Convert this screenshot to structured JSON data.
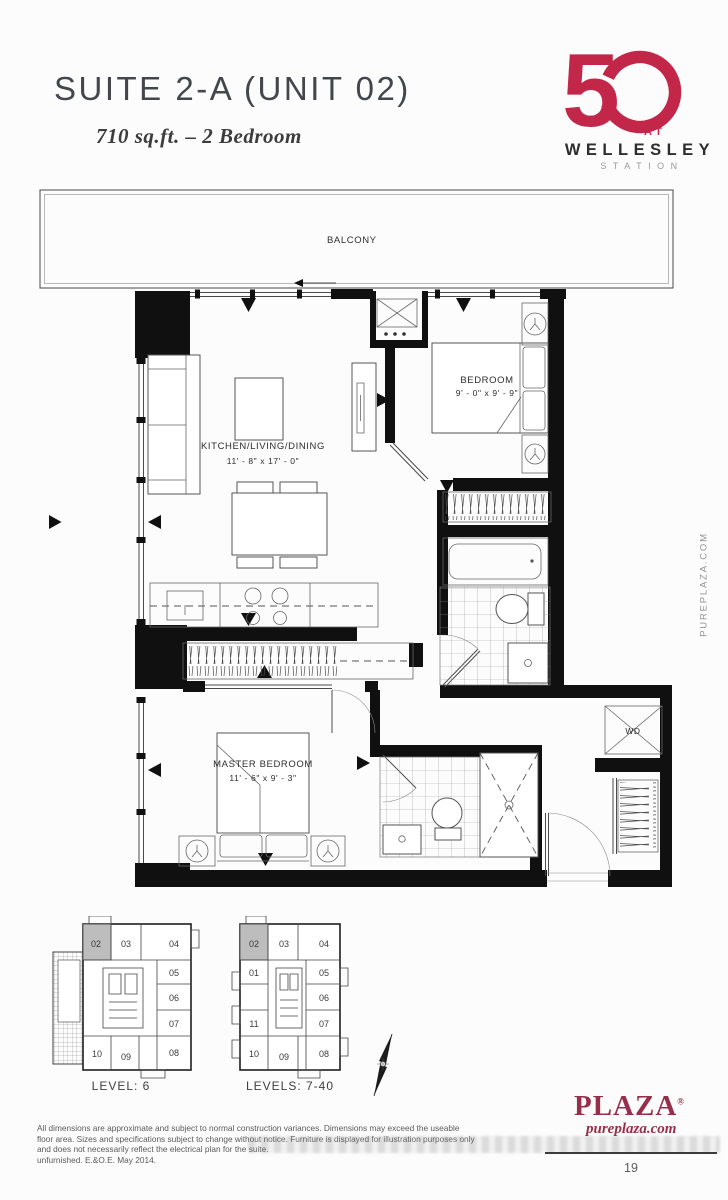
{
  "page": {
    "background": "#fcfcfc",
    "page_number": "19"
  },
  "header": {
    "title": "SUITE 2-A (UNIT 02)",
    "subtitle": "710 sq.ft. – 2 Bedroom"
  },
  "logo": {
    "digit": "5",
    "at": "AT",
    "name": "WELLESLEY",
    "sub": "STATION",
    "red": "#c2274a"
  },
  "plan": {
    "balcony": "BALCONY",
    "kitchen": {
      "label": "KITCHEN/LIVING/DINING",
      "dims": "11' - 8\" x 17' - 0\""
    },
    "bedroom": {
      "label": "BEDROOM",
      "dims": "9' - 0\" x 9' - 9\""
    },
    "master": {
      "label": "MASTER BEDROOM",
      "dims": "11' - 6\" x 9' - 3\""
    },
    "laundry": "WD"
  },
  "watermark_side": "PUREPLAZA.COM",
  "keyplan1": {
    "caption": "LEVEL: 6",
    "u02": "02",
    "u03": "03",
    "u04": "04",
    "u05": "05",
    "u06": "06",
    "u07": "07",
    "u08": "08",
    "u09": "09",
    "u10": "10",
    "highlight": "#bdbdbd"
  },
  "keyplan2": {
    "caption": "LEVELS: 7-40",
    "u01": "01",
    "u02": "02",
    "u03": "03",
    "u04": "04",
    "u05": "05",
    "u06": "06",
    "u07": "07",
    "u08": "08",
    "u09": "09",
    "u10": "10",
    "u11": "11",
    "highlight": "#bdbdbd"
  },
  "footer": {
    "disclaimer": [
      "All dimensions are approximate and subject to normal construction variances. Dimensions may exceed the useable",
      "floor area. Sizes and specifications subject to change without notice. Furniture is displayed for illustration purposes only",
      "and does not necessarily reflect the electrical plan for the suite.",
      "unfurnished. E.&O.E. May 2014."
    ],
    "brand": "PLAZA",
    "reg": "®",
    "brand_site": "pureplaza.com",
    "plaza_color": "#96304a"
  }
}
